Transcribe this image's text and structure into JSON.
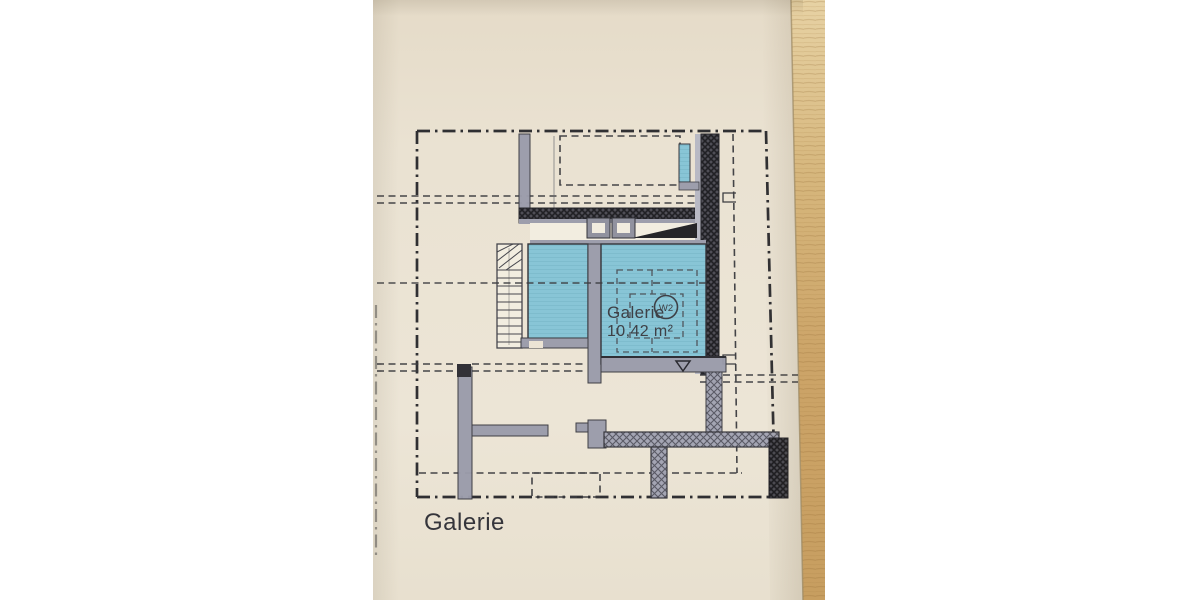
{
  "photo": {
    "background_color": "#ffffff",
    "paper_color": "#eae2d2",
    "wood_color": "#c9a266"
  },
  "plan": {
    "caption": "Galerie",
    "room": {
      "name": "Galerie",
      "area": "10,42 m²",
      "unit": "W2"
    },
    "colors": {
      "room_fill": "#85c5d7",
      "wall_gray": "#9b9cab",
      "wall_dark": "#3f3f47",
      "line": "#26262a"
    }
  }
}
